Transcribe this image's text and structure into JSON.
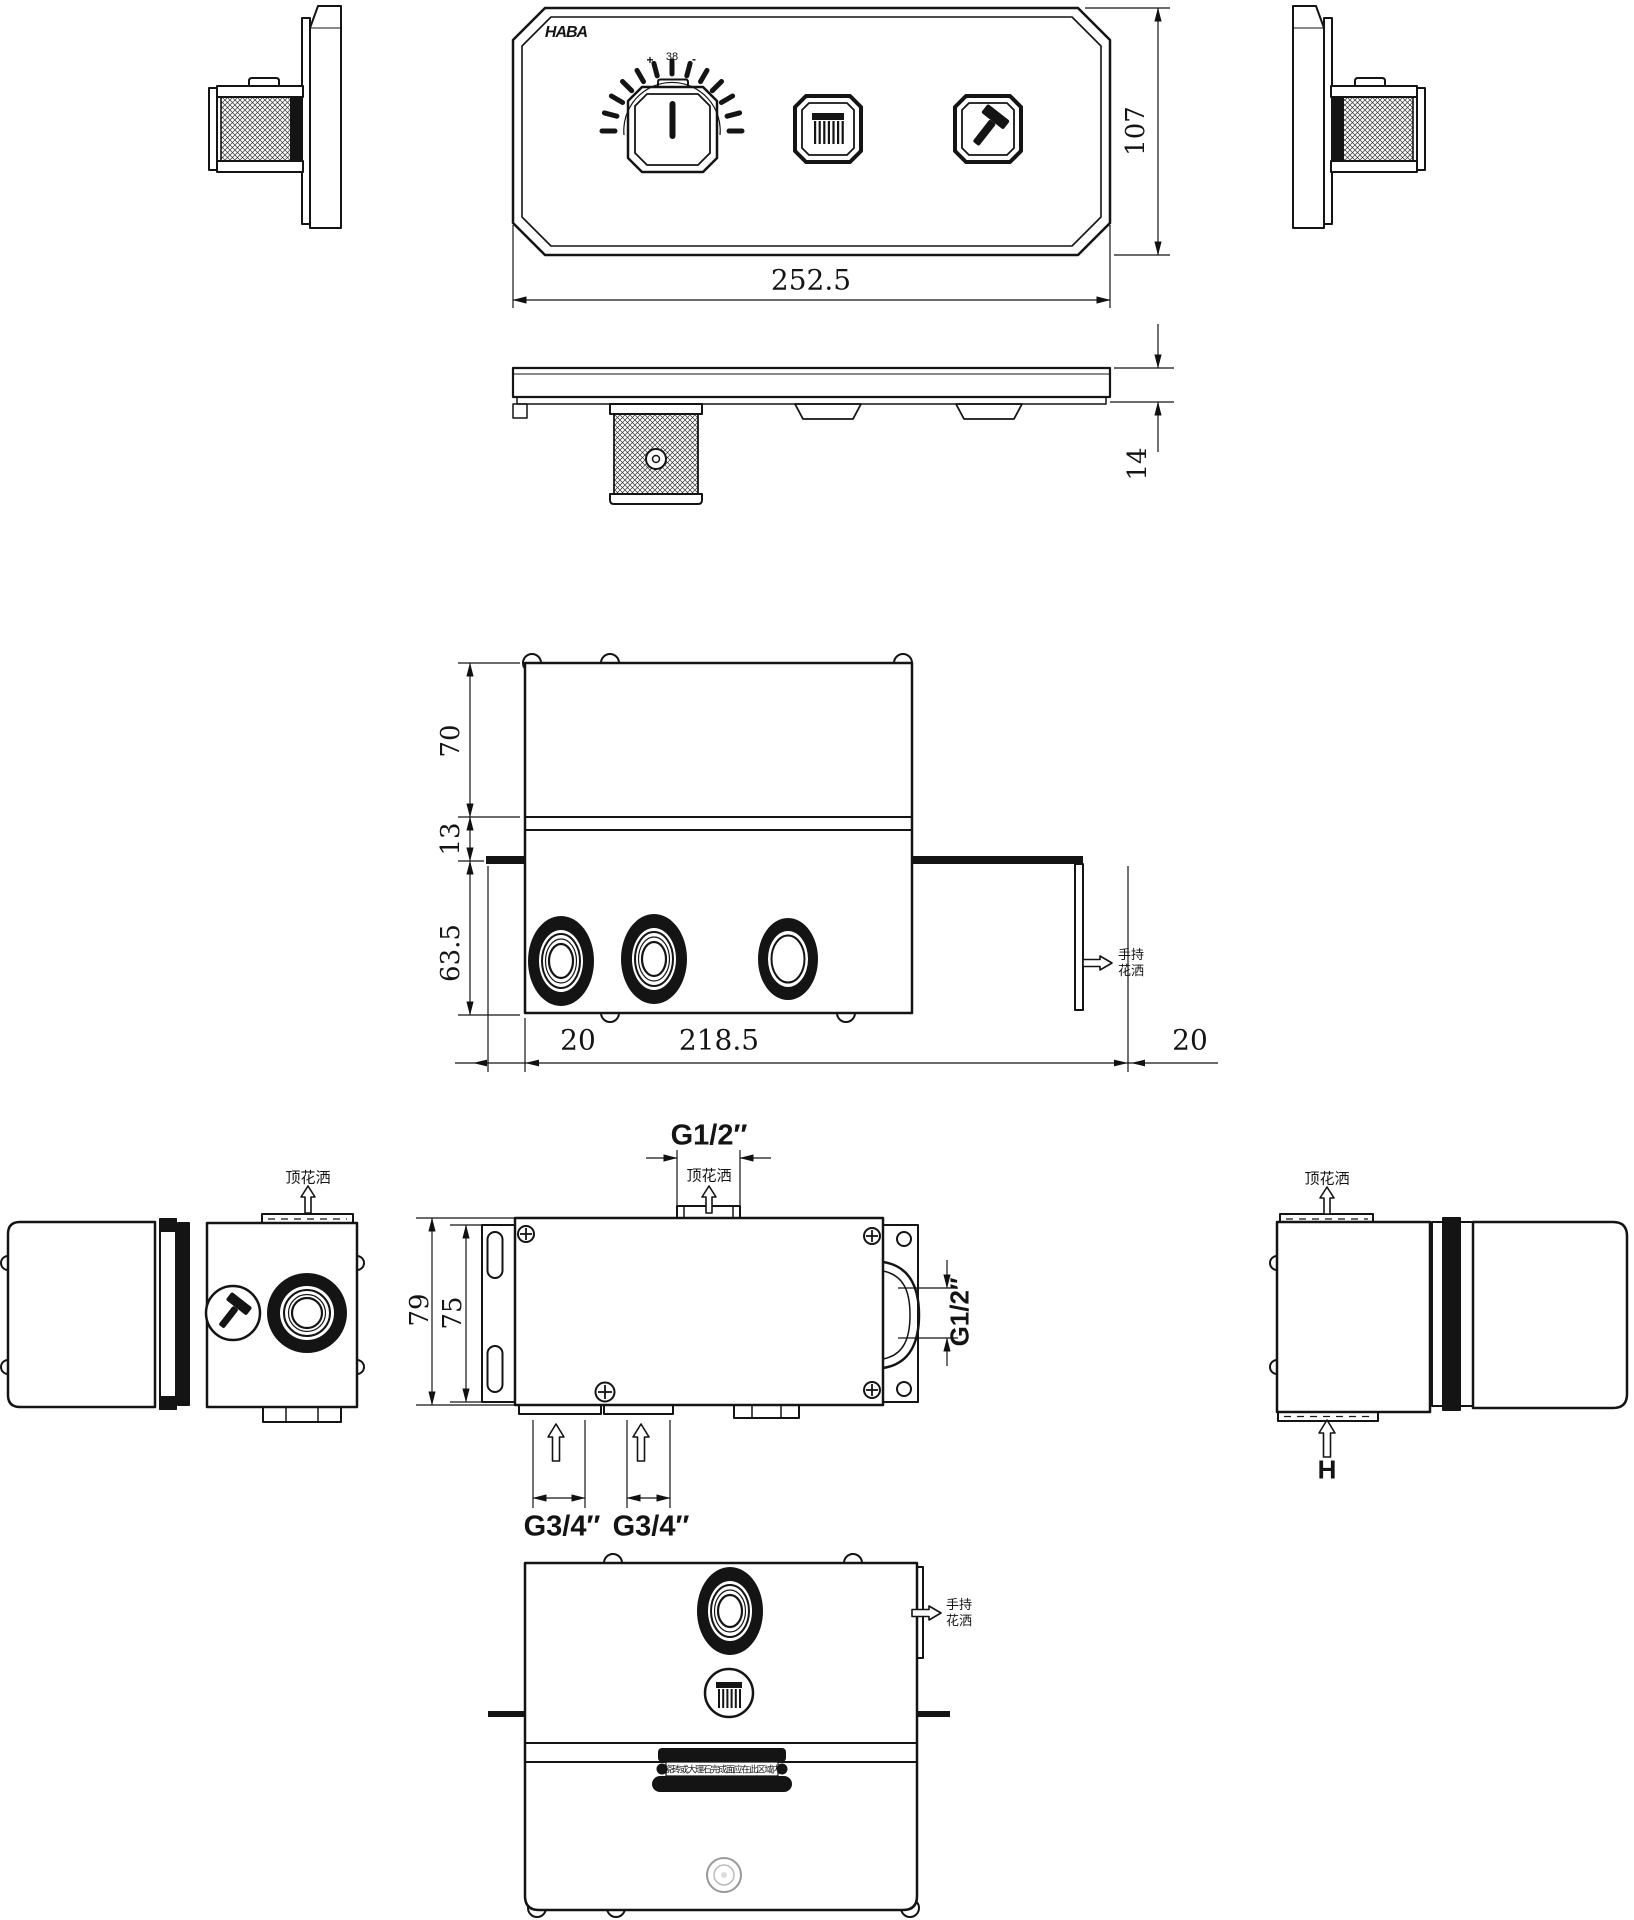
{
  "drawing": {
    "brand": "HABA",
    "dial": {
      "plus": "+",
      "temperature": "38",
      "minus": "-"
    },
    "dims": {
      "panel_width": "252.5",
      "panel_height": "107",
      "panel_thickness": "14",
      "body_upper": "70",
      "body_flange": "13",
      "body_lower": "63.5",
      "offset_left": "20",
      "port_span": "218.5",
      "offset_right": "20",
      "bracket_outer": "79",
      "bracket_inner": "75",
      "height_ref": "H"
    },
    "ports": {
      "top_outlet": "G1/2″",
      "side_outlet": "G1/2″",
      "inlet_left": "G3/4″",
      "inlet_right": "G3/4″"
    },
    "notes": {
      "top_shower": "顶花洒",
      "hand_shower": "手持花洒",
      "tile": "瓷砖或大理石完成面应在此区域内"
    }
  }
}
